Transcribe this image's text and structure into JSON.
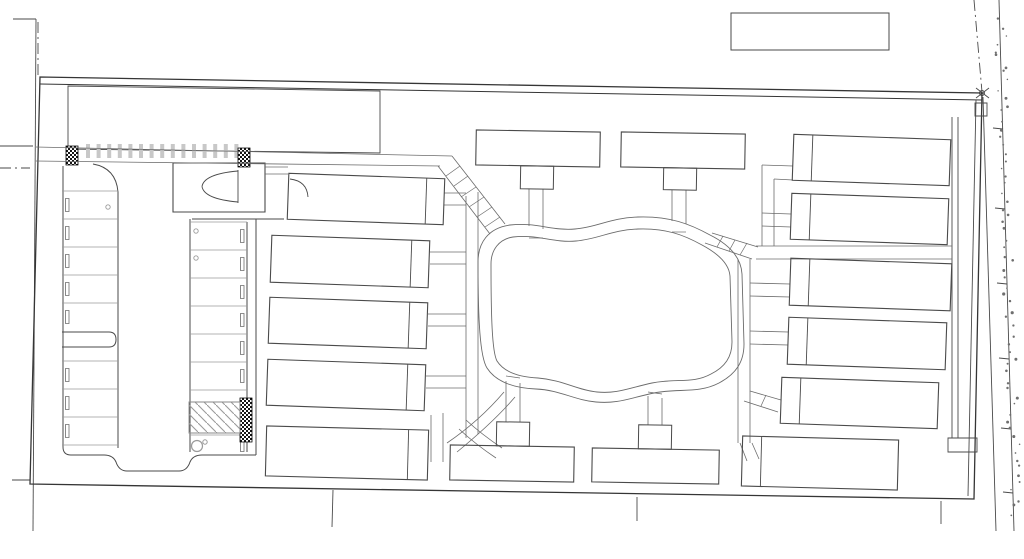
{
  "meta": {
    "title": "Architectural site plan line drawing — apartment complex with central courtyard loop, perimeter buildings and west parking lot",
    "drawing_type": "site-plan",
    "inventory": {
      "buildings_total": 15,
      "buildings_left_column": 5,
      "buildings_top_row": 2,
      "buildings_bottom_row": 2,
      "buildings_right_column": 6,
      "clubhouse": 1,
      "parking_stall_rows": 2,
      "accessible_parking_aisle": 1,
      "central_loop_path": 1
    }
  },
  "colors": {
    "bg": "#ffffff",
    "line": "#4a4a4a",
    "boundary": "#353535",
    "walk": "#6b6b6b",
    "light": "#9a9a9a",
    "faint": "#c8c8c8",
    "hatch_dark": "#161616",
    "dots": "#6f6f6f"
  },
  "roads": {
    "solid": [
      [
        13,
        19,
        36,
        19
      ],
      [
        36,
        19,
        33,
        531
      ],
      [
        0,
        146,
        33,
        146
      ],
      [
        12,
        480,
        30,
        480
      ],
      [
        983,
        97,
        996,
        531
      ],
      [
        999,
        0,
        1014,
        531
      ],
      [
        333,
        490,
        332,
        527
      ],
      [
        637,
        497,
        637,
        521
      ],
      [
        941,
        501,
        941,
        524
      ],
      [
        993,
        128,
        1003,
        129
      ],
      [
        995,
        208,
        1005,
        209
      ],
      [
        997,
        283,
        1007,
        284
      ],
      [
        999,
        358,
        1009,
        359
      ],
      [
        1001,
        428,
        1011,
        429
      ],
      [
        1003,
        492,
        1013,
        493
      ]
    ],
    "dashdot": [
      [
        38,
        22,
        38,
        75
      ],
      [
        0,
        168,
        30,
        168
      ],
      [
        974,
        0,
        982,
        92
      ]
    ],
    "corner_marker": {
      "lines": [
        [
          976,
          88,
          989,
          98
        ],
        [
          976,
          98,
          989,
          88
        ]
      ],
      "circle": [
        982,
        93,
        2.5
      ]
    }
  },
  "boundary": {
    "outline": [
      [
        40,
        77
      ],
      [
        982,
        93
      ],
      [
        974,
        499
      ],
      [
        30,
        484
      ]
    ],
    "inner_top": [
      40,
      84,
      982,
      100
    ],
    "top_left_rect": [
      [
        68,
        86
      ],
      [
        380,
        91
      ],
      [
        380,
        153
      ],
      [
        68,
        149
      ]
    ],
    "top_right_rect": [
      731,
      13,
      158,
      37
    ],
    "right_strip_lines": [
      [
        952,
        117,
        952,
        438
      ],
      [
        958,
        117,
        958,
        438
      ],
      [
        976,
        100,
        968,
        496
      ]
    ],
    "right_strip_rects": [
      [
        948,
        438,
        29,
        14
      ],
      [
        975,
        103,
        12,
        13
      ]
    ]
  },
  "parking": {
    "curb_paths": [
      "M63,166 L63,447",
      "M63,447 Q63,455 71,455 L104,455 Q113,455 116,462 Q119,471 127,471 L179,471 Q187,471 190,462 Q193,455 202,455 L247,455 L256,455",
      "M93,164 Q116,168 118,192 L118,448",
      "M190,219 L190,452",
      "M247,222 L247,452",
      "M256,219 L256,455",
      "M192,219 L284,219",
      "M62,332 L109,332 Q116,332 116,339.5 Q116,347 109,347 L62,347"
    ],
    "stall_lines_west": {
      "x1": 62,
      "x2": 118,
      "ys": [
        191,
        219,
        247,
        275,
        303,
        361,
        389,
        417,
        445
      ]
    },
    "stall_lines_east": {
      "x1": 190,
      "x2": 247,
      "ys": [
        222,
        250,
        278,
        306,
        334,
        362,
        390,
        435
      ]
    },
    "wheel_stops_west": {
      "x": 65.5,
      "w": 3.5,
      "h": 13,
      "centers": [
        205,
        233,
        261,
        289,
        317,
        375,
        403,
        431
      ]
    },
    "wheel_stops_east": {
      "x": 240.5,
      "w": 3.5,
      "h": 13,
      "centers": [
        236,
        264,
        292,
        320,
        348,
        376,
        445
      ]
    },
    "tick_row": {
      "x0": 88,
      "dx": 10.6,
      "n": 15,
      "y1": 144,
      "y2": 158,
      "w": 4
    },
    "hatch_rects_dark": [
      [
        66,
        146,
        12,
        19
      ],
      [
        238,
        148,
        12,
        19
      ],
      [
        240,
        398,
        12,
        44
      ]
    ],
    "accessible_aisle": [
      189,
      402,
      51,
      31
    ],
    "accessible_symbol": {
      "circle": [
        197,
        446,
        5.5
      ],
      "head": [
        205,
        442,
        2.2
      ]
    },
    "poles": [
      [
        108,
        207
      ],
      [
        196,
        231
      ],
      [
        196,
        258
      ]
    ]
  },
  "clubhouse": {
    "rect": [
      173,
      163,
      92,
      49
    ],
    "door_chord": [
      238,
      170,
      238,
      203
    ],
    "door_arcs": [
      "M238,171 Q204,174 202,186.5",
      "M238,202 Q204,199 202,186.5"
    ],
    "side_walk_pair": [
      [
        265,
        167,
        288,
        167
      ],
      [
        265,
        174,
        288,
        174
      ]
    ],
    "l1_door_arc": "M290,179 Q307,181 308,197"
  },
  "loop": {
    "outer": "M478,262 C478,243 488,228 510,225 C536,222 552,231 575,229 C598,227 610,218 638,217 C670,216 690,224 710,235 C728,244 741,256 742,274 L744,344 C744,362 736,374 719,383 C698,394 678,388 654,393 C630,398 618,404 596,402 C574,400 560,390 536,389 C514,388 496,382 487,368 C480,357 478,320 478,262 Z",
    "inner": "M491,264 C491,250 499,239 513,237 C537,234 553,243 576,241 C599,239 611,230 638,229 C666,228 684,235 702,245 C717,253 729,263 730,276 L732,342 C732,357 725,367 711,374 C693,384 676,378 652,383 C629,388 617,394 597,392 C577,390 563,380 538,378 C518,377 504,372 497,361 C492,352 491,315 491,264 Z"
  },
  "walks": {
    "lines": [
      [
        36,
        147,
        452,
        156
      ],
      [
        36,
        161,
        440,
        166
      ],
      [
        452,
        156,
        505,
        224
      ],
      [
        438,
        166,
        490,
        234
      ],
      [
        466,
        196,
        466,
        438
      ],
      [
        478,
        192,
        478,
        434
      ],
      [
        444,
        193,
        466,
        193
      ],
      [
        444,
        205,
        466,
        205
      ],
      [
        430,
        252,
        466,
        252
      ],
      [
        430,
        264,
        466,
        264
      ],
      [
        428,
        314,
        466,
        314
      ],
      [
        428,
        326,
        466,
        326
      ],
      [
        426,
        376,
        466,
        376
      ],
      [
        426,
        388,
        466,
        388
      ],
      [
        431,
        415,
        431,
        462
      ],
      [
        443,
        413,
        443,
        462
      ],
      [
        529,
        189,
        529,
        226
      ],
      [
        543,
        189,
        543,
        229
      ],
      [
        672,
        190,
        672,
        221
      ],
      [
        686,
        190,
        686,
        224
      ],
      [
        506,
        381,
        506,
        422
      ],
      [
        520,
        383,
        520,
        422
      ],
      [
        648,
        396,
        648,
        425
      ],
      [
        662,
        398,
        662,
        425
      ],
      [
        756,
        246,
        952,
        246
      ],
      [
        756,
        259,
        952,
        259
      ],
      [
        762,
        165,
        793,
        166
      ],
      [
        762,
        165,
        762,
        246
      ],
      [
        774,
        179,
        793,
        180
      ],
      [
        774,
        179,
        774,
        246
      ],
      [
        762,
        213,
        791,
        214
      ],
      [
        762,
        226,
        791,
        227
      ],
      [
        712,
        233,
        758,
        247
      ],
      [
        705,
        243,
        752,
        259
      ],
      [
        738,
        259,
        738,
        443
      ],
      [
        750,
        259,
        750,
        443
      ],
      [
        750,
        283,
        790,
        284
      ],
      [
        750,
        296,
        790,
        297
      ],
      [
        750,
        331,
        788,
        332
      ],
      [
        750,
        344,
        788,
        345
      ],
      [
        750,
        391,
        781,
        400
      ],
      [
        744,
        401,
        778,
        412
      ],
      [
        740,
        443,
        747,
        461
      ],
      [
        752,
        443,
        759,
        459
      ]
    ],
    "curves": [
      "M466,420 C478,431 490,440 502,448",
      "M459,429 C472,441 484,450 496,458",
      "M504,392 C487,412 469,428 447,443",
      "M515,397 C498,417 479,434 457,452"
    ],
    "ticks": [
      [
        460,
        166,
        446,
        176
      ],
      [
        468,
        176,
        454,
        186
      ],
      [
        476,
        187,
        461,
        197
      ],
      [
        484,
        197,
        469,
        207
      ],
      [
        492,
        207,
        477,
        217
      ],
      [
        500,
        217,
        485,
        227
      ],
      [
        723,
        236,
        717,
        247
      ],
      [
        735,
        240,
        729,
        251
      ],
      [
        747,
        243,
        740,
        255
      ],
      [
        766,
        395,
        761,
        406
      ],
      [
        529,
        238,
        543,
        238
      ],
      [
        672,
        232,
        686,
        232
      ],
      [
        506,
        376,
        520,
        378
      ],
      [
        648,
        392,
        662,
        394
      ]
    ]
  },
  "buildings": {
    "left": [
      {
        "x": 288,
        "y": 176,
        "w": 156,
        "h": 46,
        "cap": "right",
        "capW": 18,
        "tilt": 2
      },
      {
        "x": 271,
        "y": 238,
        "w": 158,
        "h": 47,
        "cap": "right",
        "capW": 18,
        "tilt": 2
      },
      {
        "x": 269,
        "y": 300,
        "w": 158,
        "h": 46,
        "cap": "right",
        "capW": 18,
        "tilt": 2
      },
      {
        "x": 267,
        "y": 362,
        "w": 158,
        "h": 46,
        "cap": "right",
        "capW": 18,
        "tilt": 2
      },
      {
        "x": 266,
        "y": 428,
        "w": 162,
        "h": 50,
        "cap": "right",
        "capW": 20,
        "tilt": 1.5
      }
    ],
    "top": [
      {
        "x": 476,
        "y": 131,
        "w": 124,
        "h": 35,
        "tilt": 1,
        "porch": {
          "x": 521,
          "y": 166,
          "w": 33,
          "h": 23
        }
      },
      {
        "x": 621,
        "y": 133,
        "w": 124,
        "h": 35,
        "tilt": 1,
        "porch": {
          "x": 664,
          "y": 168,
          "w": 33,
          "h": 22
        }
      }
    ],
    "bottom": [
      {
        "x": 450,
        "y": 446,
        "w": 124,
        "h": 35,
        "tilt": 1,
        "porch": {
          "x": 496,
          "y": 422,
          "w": 33,
          "h": 24
        }
      },
      {
        "x": 592,
        "y": 449,
        "w": 127,
        "h": 34,
        "tilt": 1,
        "porch": {
          "x": 638,
          "y": 425,
          "w": 33,
          "h": 24
        }
      }
    ],
    "right": [
      {
        "x": 793,
        "y": 137,
        "w": 157,
        "h": 46,
        "cap": "left",
        "capW": 19,
        "tilt": 2
      },
      {
        "x": 791,
        "y": 196,
        "w": 157,
        "h": 46,
        "cap": "left",
        "capW": 19,
        "tilt": 2
      },
      {
        "x": 790,
        "y": 261,
        "w": 161,
        "h": 47,
        "cap": "left",
        "capW": 19,
        "tilt": 2
      },
      {
        "x": 788,
        "y": 320,
        "w": 158,
        "h": 47,
        "cap": "left",
        "capW": 19,
        "tilt": 2
      },
      {
        "x": 781,
        "y": 380,
        "w": 157,
        "h": 46,
        "cap": "left",
        "capW": 19,
        "tilt": 2
      },
      {
        "x": 742,
        "y": 438,
        "w": 156,
        "h": 50,
        "cap": "left",
        "capW": 19,
        "tilt": 1.5
      }
    ]
  },
  "texture": {
    "seed": 7,
    "dot_count": 64,
    "y0": 18,
    "dy": 7.9,
    "x_base": 997,
    "x_slope": 0.03
  }
}
